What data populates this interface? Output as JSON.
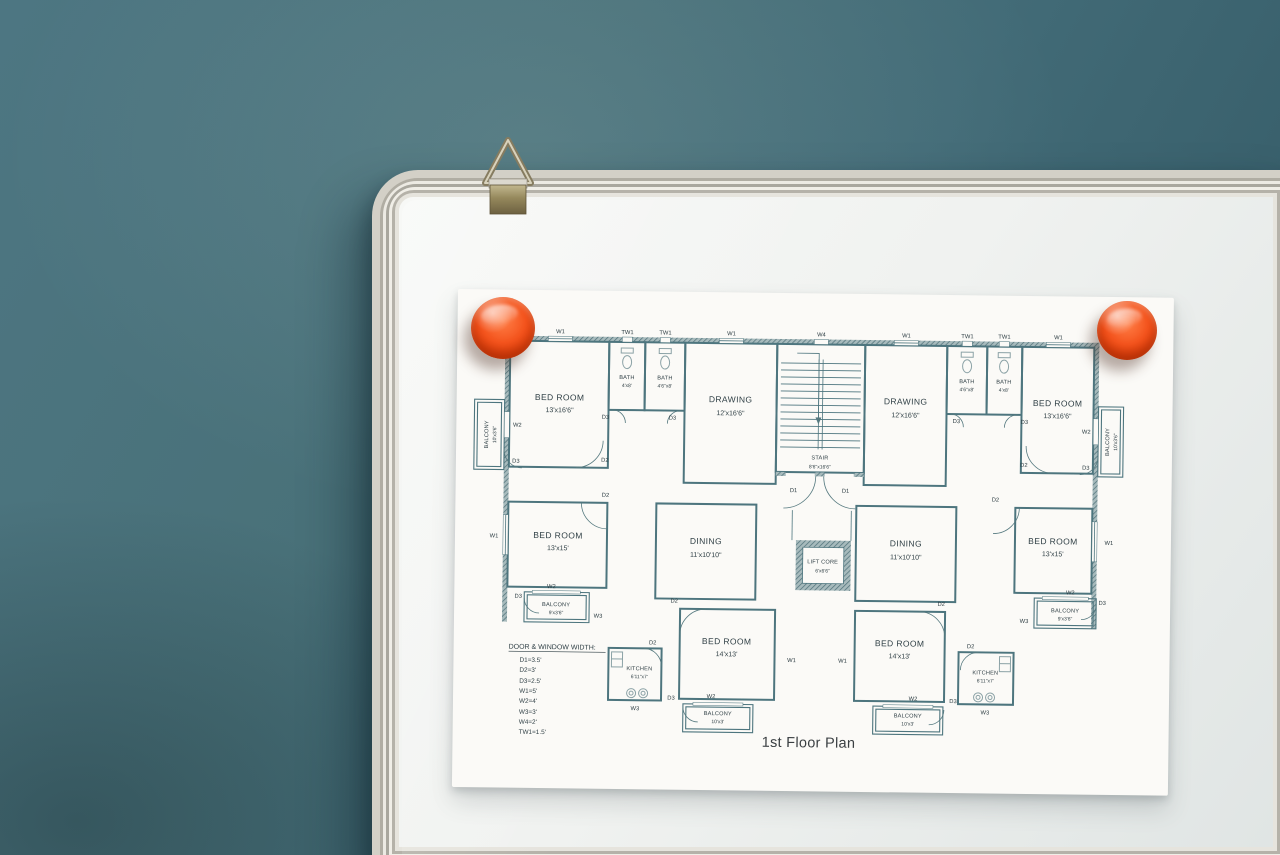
{
  "scene": {
    "wall_color": "#47707c",
    "board_color": "#f2f3f1",
    "magnet_color": "#f2500f",
    "plan_ink": "#4d757e",
    "text_ink": "#2e3e44"
  },
  "plan": {
    "title": "1st Floor Plan",
    "rooms": {
      "bedroom_tl": {
        "name": "BED ROOM",
        "dims": "13'x16'6\""
      },
      "bedroom_tr": {
        "name": "BED ROOM",
        "dims": "13'x16'6\""
      },
      "bedroom_ml": {
        "name": "BED ROOM",
        "dims": "13'x15'"
      },
      "bedroom_mr": {
        "name": "BED ROOM",
        "dims": "13'x15'"
      },
      "bedroom_bl": {
        "name": "BED ROOM",
        "dims": "14'x13'"
      },
      "bedroom_br": {
        "name": "BED ROOM",
        "dims": "14'x13'"
      },
      "drawing_l": {
        "name": "DRAWING",
        "dims": "12'x16'6\""
      },
      "drawing_r": {
        "name": "DRAWING",
        "dims": "12'x16'6\""
      },
      "dining_l": {
        "name": "DINING",
        "dims": "11'x10'10\""
      },
      "dining_r": {
        "name": "DINING",
        "dims": "11'x10'10\""
      },
      "bath_outer_l": {
        "name": "BATH",
        "dims": "4'x8'"
      },
      "bath_inner_l": {
        "name": "BATH",
        "dims": "4'6\"x8'"
      },
      "bath_inner_r": {
        "name": "BATH",
        "dims": "4'6\"x8'"
      },
      "bath_outer_r": {
        "name": "BATH",
        "dims": "4'x8'"
      },
      "kitchen_l": {
        "name": "KITCHEN",
        "dims": "6'11\"x7'"
      },
      "kitchen_r": {
        "name": "KITCHEN",
        "dims": "6'11\"x7'"
      },
      "stair": {
        "name": "STAIR",
        "dims": "8'6\"x16'6\""
      },
      "lift": {
        "name": "LIFT CORE",
        "dims": "6'x6'6\""
      },
      "balcony_tl": {
        "name": "BALCONY",
        "dims": "10'x3'6\""
      },
      "balcony_tr": {
        "name": "BALCONY",
        "dims": "10'x3'6\""
      },
      "balcony_ml": {
        "name": "BALCONY",
        "dims": "9'x3'6\""
      },
      "balcony_mr": {
        "name": "BALCONY",
        "dims": "9'x3'6\""
      },
      "balcony_bl": {
        "name": "BALCONY",
        "dims": "10'x3'"
      },
      "balcony_br": {
        "name": "BALCONY",
        "dims": "10'x3'"
      }
    },
    "codes": {
      "w1": "W1",
      "w2": "W2",
      "w3": "W3",
      "w4": "W4",
      "d1": "D1",
      "d2": "D2",
      "d3": "D3",
      "tw1": "TW1"
    },
    "legend": {
      "title": "DOOR & WINDOW WIDTH:",
      "items": [
        "D1=3.5'",
        "D2=3'",
        "D3=2.5'",
        "W1=5'",
        "W2=4'",
        "W3=3'",
        "W4=2'",
        "TW1=1.5'"
      ]
    }
  }
}
